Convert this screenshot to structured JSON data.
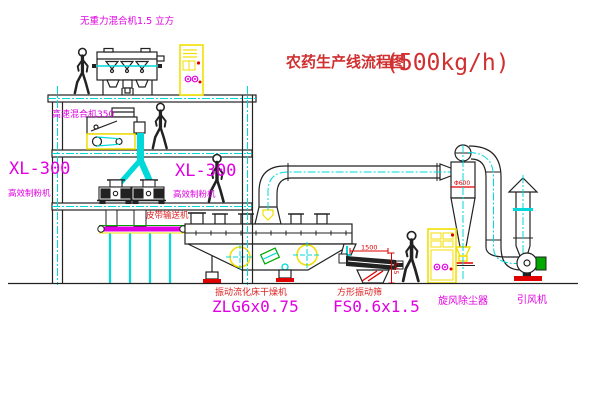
{
  "title": {
    "main": "农药生产线流程图",
    "capacity": "(500kg/h)"
  },
  "labels": {
    "gravity_mixer": "无重力混合机1.5 立方",
    "high_speed_mixer": "高速混合机350",
    "mill_left_model": "XL-300",
    "mill_left_name": "高效制粉机",
    "mill_right_model": "XL-300",
    "mill_right_name": "高效制粉机",
    "belt_conveyor": "皮带输送机",
    "dryer_name": "振动流化床干燥机",
    "dryer_model": "ZLG6x0.75",
    "screen_name": "方形振动筛",
    "screen_model": "FS0.6x1.5",
    "cyclone": "旋风除尘器",
    "fan": "引风机"
  },
  "dimensions": {
    "screen_length": "1500",
    "screen_side": "545",
    "cyclone_note": "Φ600"
  },
  "colors": {
    "line": "#222222",
    "yellow": "#f2df00",
    "cyan": "#00d9d9",
    "magenta": "#e100e1",
    "red": "#d03030",
    "green": "#00a800"
  }
}
